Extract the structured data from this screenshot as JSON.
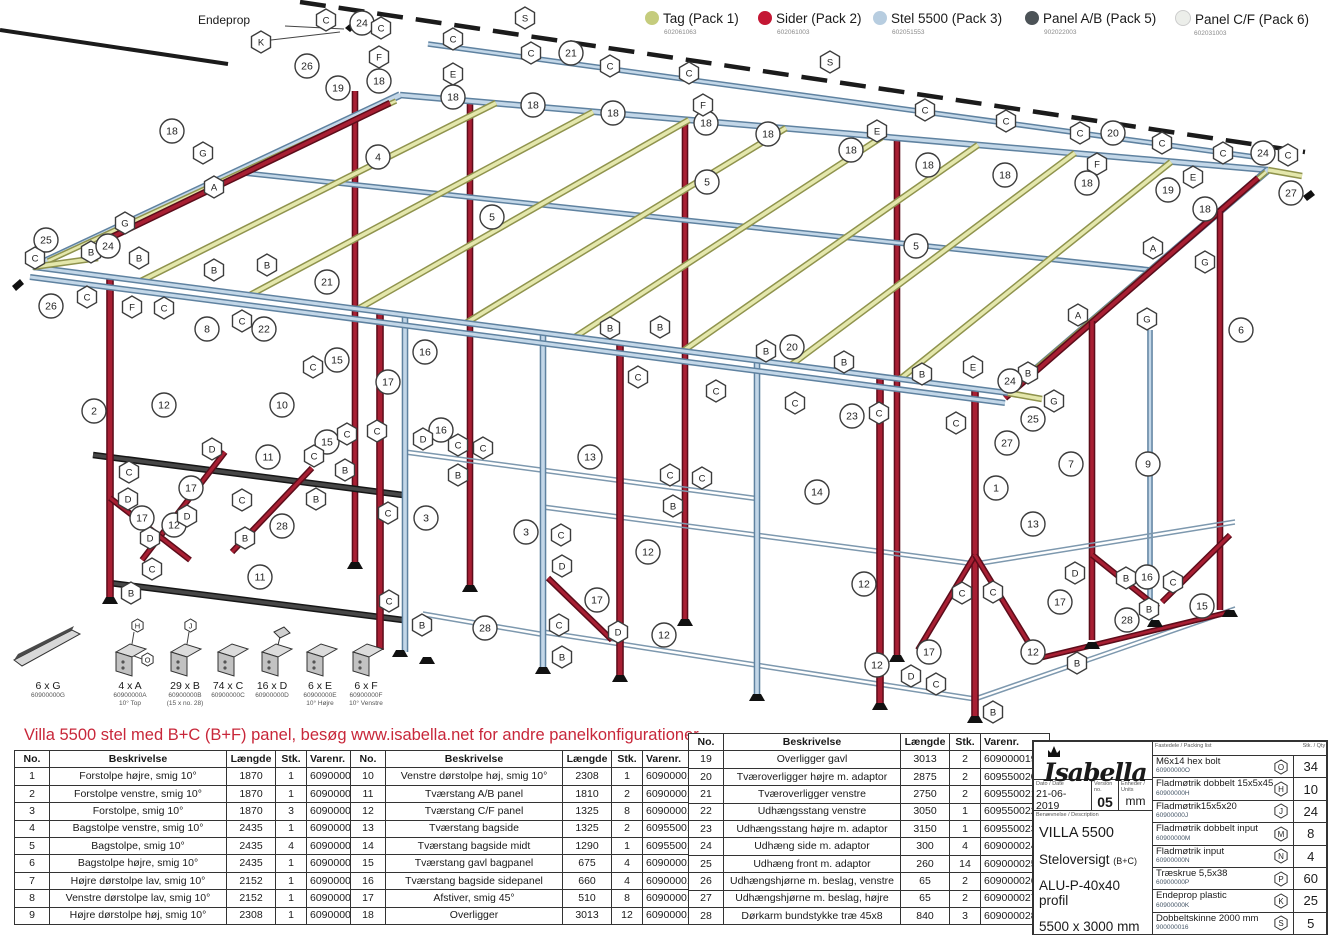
{
  "legend": {
    "items": [
      {
        "label": "Tag (Pack 1)",
        "code": "602061063",
        "color": "#c5cc7d"
      },
      {
        "label": "Sider (Pack 2)",
        "code": "602061003",
        "color": "#c41734"
      },
      {
        "label": "Stel 5500 (Pack 3)",
        "code": "602051553",
        "color": "#b7cde0"
      },
      {
        "label": "Panel A/B (Pack 5)",
        "code": "902022003",
        "color": "#4c5357"
      },
      {
        "label": "Panel C/F (Pack 6)",
        "code": "602031003",
        "color": "#eceeea"
      }
    ]
  },
  "note": "Villa 5500 stel med B+C (B+F) panel, besøg www.isabella.net for andre panelkonfigurationer",
  "diagram": {
    "endeprop": "Endeprop",
    "callouts": [
      [
        "h",
        "K",
        261,
        42
      ],
      [
        "c",
        "24",
        362,
        23
      ],
      [
        "h",
        "C",
        326,
        20
      ],
      [
        "h",
        "C",
        381,
        28
      ],
      [
        "h",
        "F",
        379,
        57
      ],
      [
        "c",
        "26",
        307,
        66
      ],
      [
        "c",
        "19",
        338,
        88
      ],
      [
        "c",
        "18",
        172,
        131
      ],
      [
        "h",
        "G",
        203,
        153
      ],
      [
        "h",
        "A",
        214,
        187
      ],
      [
        "c",
        "4",
        378,
        157
      ],
      [
        "c",
        "18",
        379,
        81
      ],
      [
        "h",
        "S",
        525,
        18
      ],
      [
        "h",
        "C",
        453,
        39
      ],
      [
        "c",
        "21",
        571,
        53
      ],
      [
        "h",
        "C",
        531,
        53
      ],
      [
        "h",
        "C",
        610,
        66
      ],
      [
        "h",
        "C",
        689,
        73
      ],
      [
        "h",
        "E",
        453,
        74
      ],
      [
        "c",
        "18",
        453,
        97
      ],
      [
        "c",
        "18",
        533,
        105
      ],
      [
        "c",
        "18",
        613,
        113
      ],
      [
        "c",
        "18",
        706,
        123
      ],
      [
        "c",
        "18",
        768,
        134
      ],
      [
        "c",
        "18",
        851,
        150
      ],
      [
        "c",
        "18",
        928,
        165
      ],
      [
        "c",
        "18",
        1005,
        175
      ],
      [
        "c",
        "18",
        1087,
        183
      ],
      [
        "c",
        "18",
        1205,
        209
      ],
      [
        "c",
        "5",
        492,
        217
      ],
      [
        "c",
        "5",
        707,
        182
      ],
      [
        "c",
        "5",
        916,
        246
      ],
      [
        "h",
        "F",
        703,
        105
      ],
      [
        "h",
        "E",
        877,
        131
      ],
      [
        "h",
        "C",
        925,
        110
      ],
      [
        "h",
        "C",
        1006,
        121
      ],
      [
        "h",
        "S",
        830,
        62
      ],
      [
        "c",
        "20",
        1113,
        133
      ],
      [
        "h",
        "C",
        1080,
        133
      ],
      [
        "h",
        "C",
        1162,
        143
      ],
      [
        "h",
        "C",
        1223,
        153
      ],
      [
        "h",
        "F",
        1097,
        164
      ],
      [
        "h",
        "E",
        1193,
        177
      ],
      [
        "c",
        "24",
        1263,
        153
      ],
      [
        "h",
        "C",
        1288,
        155
      ],
      [
        "c",
        "27",
        1291,
        193
      ],
      [
        "c",
        "19",
        1168,
        190
      ],
      [
        "h",
        "A",
        1153,
        248
      ],
      [
        "h",
        "G",
        1205,
        262
      ],
      [
        "h",
        "A",
        1078,
        315
      ],
      [
        "h",
        "G",
        1147,
        319
      ],
      [
        "c",
        "6",
        1241,
        330
      ],
      [
        "c",
        "25",
        46,
        240
      ],
      [
        "h",
        "C",
        35,
        258
      ],
      [
        "h",
        "B",
        91,
        252
      ],
      [
        "c",
        "24",
        108,
        246
      ],
      [
        "h",
        "G",
        125,
        223
      ],
      [
        "c",
        "26",
        51,
        306
      ],
      [
        "h",
        "C",
        87,
        297
      ],
      [
        "h",
        "F",
        132,
        307
      ],
      [
        "h",
        "C",
        164,
        308
      ],
      [
        "h",
        "B",
        139,
        258
      ],
      [
        "h",
        "B",
        214,
        270
      ],
      [
        "h",
        "B",
        267,
        265
      ],
      [
        "c",
        "21",
        327,
        282
      ],
      [
        "c",
        "22",
        264,
        329
      ],
      [
        "h",
        "C",
        242,
        321
      ],
      [
        "c",
        "8",
        207,
        329
      ],
      [
        "c",
        "2",
        94,
        411
      ],
      [
        "c",
        "12",
        164,
        405
      ],
      [
        "c",
        "10",
        282,
        405
      ],
      [
        "c",
        "11",
        268,
        457
      ],
      [
        "c",
        "15",
        337,
        360
      ],
      [
        "h",
        "C",
        313,
        367
      ],
      [
        "c",
        "15",
        327,
        442
      ],
      [
        "h",
        "C",
        347,
        434
      ],
      [
        "h",
        "B",
        345,
        470
      ],
      [
        "c",
        "16",
        425,
        352
      ],
      [
        "c",
        "17",
        388,
        382
      ],
      [
        "h",
        "B",
        610,
        328
      ],
      [
        "h",
        "B",
        660,
        327
      ],
      [
        "h",
        "B",
        766,
        351
      ],
      [
        "h",
        "B",
        844,
        362
      ],
      [
        "h",
        "B",
        922,
        374
      ],
      [
        "h",
        "C",
        638,
        377
      ],
      [
        "h",
        "C",
        716,
        391
      ],
      [
        "h",
        "C",
        795,
        403
      ],
      [
        "h",
        "C",
        879,
        413
      ],
      [
        "h",
        "C",
        956,
        423
      ],
      [
        "c",
        "20",
        792,
        347
      ],
      [
        "c",
        "23",
        852,
        416
      ],
      [
        "h",
        "E",
        973,
        367
      ],
      [
        "h",
        "B",
        1028,
        373
      ],
      [
        "c",
        "24",
        1010,
        381
      ],
      [
        "h",
        "G",
        1054,
        401
      ],
      [
        "c",
        "25",
        1033,
        419
      ],
      [
        "c",
        "27",
        1007,
        443
      ],
      [
        "c",
        "16",
        441,
        430
      ],
      [
        "h",
        "D",
        423,
        439
      ],
      [
        "h",
        "C",
        458,
        445
      ],
      [
        "h",
        "C",
        483,
        448
      ],
      [
        "h",
        "B",
        458,
        475
      ],
      [
        "c",
        "13",
        590,
        457
      ],
      [
        "c",
        "3",
        426,
        518
      ],
      [
        "c",
        "3",
        526,
        532
      ],
      [
        "h",
        "C",
        561,
        535
      ],
      [
        "h",
        "D",
        562,
        566
      ],
      [
        "c",
        "12",
        648,
        552
      ],
      [
        "c",
        "17",
        597,
        600
      ],
      [
        "h",
        "C",
        559,
        625
      ],
      [
        "h",
        "D",
        618,
        632
      ],
      [
        "c",
        "12",
        664,
        635
      ],
      [
        "c",
        "28",
        485,
        628
      ],
      [
        "h",
        "B",
        422,
        625
      ],
      [
        "h",
        "B",
        562,
        657
      ],
      [
        "h",
        "C",
        670,
        475
      ],
      [
        "h",
        "C",
        702,
        478
      ],
      [
        "h",
        "B",
        673,
        506
      ],
      [
        "c",
        "14",
        817,
        492
      ],
      [
        "c",
        "13",
        1033,
        524
      ],
      [
        "c",
        "12",
        864,
        584
      ],
      [
        "c",
        "12",
        877,
        665
      ],
      [
        "c",
        "1",
        996,
        488
      ],
      [
        "c",
        "7",
        1071,
        464
      ],
      [
        "c",
        "9",
        1148,
        464
      ],
      [
        "c",
        "16",
        1147,
        577
      ],
      [
        "c",
        "15",
        1202,
        606
      ],
      [
        "c",
        "28",
        1127,
        620
      ],
      [
        "c",
        "17",
        1060,
        602
      ],
      [
        "c",
        "17",
        929,
        652
      ],
      [
        "c",
        "12",
        1033,
        652
      ],
      [
        "h",
        "D",
        1075,
        573
      ],
      [
        "h",
        "B",
        1126,
        578
      ],
      [
        "h",
        "C",
        1173,
        582
      ],
      [
        "h",
        "B",
        1149,
        609
      ],
      [
        "h",
        "C",
        962,
        593
      ],
      [
        "h",
        "C",
        993,
        592
      ],
      [
        "h",
        "D",
        911,
        676
      ],
      [
        "h",
        "C",
        936,
        684
      ],
      [
        "h",
        "B",
        1077,
        663
      ],
      [
        "h",
        "B",
        993,
        712
      ],
      [
        "c",
        "11",
        260,
        577
      ],
      [
        "h",
        "C",
        129,
        472
      ],
      [
        "h",
        "D",
        212,
        449
      ],
      [
        "h",
        "C",
        242,
        500
      ],
      [
        "h",
        "D",
        128,
        499
      ],
      [
        "c",
        "17",
        191,
        488
      ],
      [
        "c",
        "17",
        142,
        518
      ],
      [
        "c",
        "12",
        174,
        525
      ],
      [
        "c",
        "28",
        282,
        526
      ],
      [
        "h",
        "D",
        187,
        516
      ],
      [
        "h",
        "D",
        150,
        538
      ],
      [
        "h",
        "B",
        245,
        538
      ],
      [
        "h",
        "C",
        152,
        569
      ],
      [
        "h",
        "B",
        131,
        593
      ],
      [
        "h",
        "C",
        314,
        456
      ],
      [
        "h",
        "C",
        377,
        431
      ],
      [
        "h",
        "B",
        316,
        499
      ],
      [
        "h",
        "C",
        388,
        513
      ],
      [
        "h",
        "C",
        389,
        601
      ]
    ]
  },
  "parts_icons": [
    {
      "qty": "6 x G",
      "code": "60900000G",
      "sub": "",
      "badges": []
    },
    {
      "qty": "4 x A",
      "code": "60900000A",
      "sub": "10° Top",
      "badges": [
        "H",
        "O"
      ]
    },
    {
      "qty": "29 x B",
      "code": "60900000B",
      "sub": "(15 x no. 28)",
      "badges": [
        "J"
      ]
    },
    {
      "qty": "74 x C",
      "code": "60900000C",
      "sub": "",
      "badges": []
    },
    {
      "qty": "16 x D",
      "code": "60900000D",
      "sub": "",
      "badges": []
    },
    {
      "qty": "6 x E",
      "code": "60900000E",
      "sub": "10° Højre",
      "badges": []
    },
    {
      "qty": "6 x F",
      "code": "60900000F",
      "sub": "10° Venstre",
      "badges": []
    }
  ],
  "tables": [
    {
      "headers": [
        "No.",
        "Beskrivelse",
        "Længde",
        "Stk.",
        "Varenr."
      ],
      "rows": [
        [
          "1",
          "Forstolpe højre, smig 10°",
          "1870",
          "1",
          "609000001"
        ],
        [
          "2",
          "Forstolpe venstre, smig 10°",
          "1870",
          "1",
          "609000002"
        ],
        [
          "3",
          "Forstolpe, smig 10°",
          "1870",
          "3",
          "609000003"
        ],
        [
          "4",
          "Bagstolpe venstre, smig 10°",
          "2435",
          "1",
          "609000004"
        ],
        [
          "5",
          "Bagstolpe, smig 10°",
          "2435",
          "4",
          "609000005"
        ],
        [
          "6",
          "Bagstolpe højre, smig 10°",
          "2435",
          "1",
          "609000006"
        ],
        [
          "7",
          "Højre dørstolpe lav, smig 10°",
          "2152",
          "1",
          "609000007"
        ],
        [
          "8",
          "Venstre dørstolpe lav, smig 10°",
          "2152",
          "1",
          "609000008"
        ],
        [
          "9",
          "Højre dørstolpe høj, smig 10°",
          "2308",
          "1",
          "609000009"
        ]
      ]
    },
    {
      "headers": [
        "No.",
        "Beskrivelse",
        "Længde",
        "Stk.",
        "Varenr."
      ],
      "rows": [
        [
          "10",
          "Venstre dørstolpe høj, smig 10°",
          "2308",
          "1",
          "609000010"
        ],
        [
          "11",
          "Tværstang A/B panel",
          "1810",
          "2",
          "609000011"
        ],
        [
          "12",
          "Tværstang C/F panel",
          "1325",
          "8",
          "609000012"
        ],
        [
          "13",
          "Tværstang bagside",
          "1325",
          "2",
          "609550013"
        ],
        [
          "14",
          "Tværstang bagside midt",
          "1290",
          "1",
          "609550014"
        ],
        [
          "15",
          "Tværstang gavl bagpanel",
          "675",
          "4",
          "609000015"
        ],
        [
          "16",
          "Tværstang bagside sidepanel",
          "660",
          "4",
          "609000016"
        ],
        [
          "17",
          "Afstiver, smig 45°",
          "510",
          "8",
          "609000017"
        ],
        [
          "18",
          "Overligger",
          "3013",
          "12",
          "609000018"
        ]
      ]
    },
    {
      "headers": [
        "No.",
        "Beskrivelse",
        "Længde",
        "Stk.",
        "Varenr."
      ],
      "rows": [
        [
          "19",
          "Overligger gavl",
          "3013",
          "2",
          "609000019"
        ],
        [
          "20",
          "Tværoverligger højre m. adaptor",
          "2875",
          "2",
          "609550020"
        ],
        [
          "21",
          "Tværoverligger venstre",
          "2750",
          "2",
          "609550021"
        ],
        [
          "22",
          "Udhængsstang venstre",
          "3050",
          "1",
          "609550022"
        ],
        [
          "23",
          "Udhængsstang højre m. adaptor",
          "3150",
          "1",
          "609550023"
        ],
        [
          "24",
          "Udhæng side m. adaptor",
          "300",
          "4",
          "609000024"
        ],
        [
          "25",
          "Udhæng front m. adaptor",
          "260",
          "14",
          "609000025"
        ],
        [
          "26",
          "Udhængshjørne m. beslag, venstre",
          "65",
          "2",
          "609000026"
        ],
        [
          "27",
          "Udhængshjørne m. beslag, højre",
          "65",
          "2",
          "609000027"
        ],
        [
          "28",
          "Dørkarm bundstykke træ 45x8",
          "840",
          "3",
          "609000028"
        ]
      ]
    }
  ],
  "title_block": {
    "brand": "Isabella",
    "date_label": "Dato / Date",
    "date": "21-06-2019",
    "version_label": "Version no.",
    "version": "05",
    "units_label": "Enheder / Units",
    "units": "mm",
    "desc_label": "Benævnelse / Description",
    "desc_lines": [
      "VILLA 5500",
      "Steloversigt (B+C)",
      "ALU-P-40x40 profil",
      "5500 x 3000 mm"
    ],
    "packing": {
      "header_left": "Fastedele / Packing list",
      "header_right": "Stk. / Qty",
      "rows": [
        {
          "name": "M6x14 hex bolt",
          "code": "60900000O",
          "badge": "O",
          "qty": "34"
        },
        {
          "name": "Fladmøtrik dobbelt 15x5x45",
          "code": "60900000H",
          "badge": "H",
          "qty": "10"
        },
        {
          "name": "Fladmøtrik15x5x20",
          "code": "60900000J",
          "badge": "J",
          "qty": "24"
        },
        {
          "name": "Fladmøtrik dobbelt input",
          "code": "60900000M",
          "badge": "M",
          "qty": "8"
        },
        {
          "name": "Fladmøtrik input",
          "code": "60900000N",
          "badge": "N",
          "qty": "4"
        },
        {
          "name": "Træskrue 5,5x38",
          "code": "60900000P",
          "badge": "P",
          "qty": "60"
        },
        {
          "name": "Endeprop plastic",
          "code": "60900000K",
          "badge": "K",
          "qty": "25"
        },
        {
          "name": "Dobbeltskinne 2000 mm",
          "code": "900000016",
          "badge": "S",
          "qty": "5"
        }
      ]
    }
  }
}
